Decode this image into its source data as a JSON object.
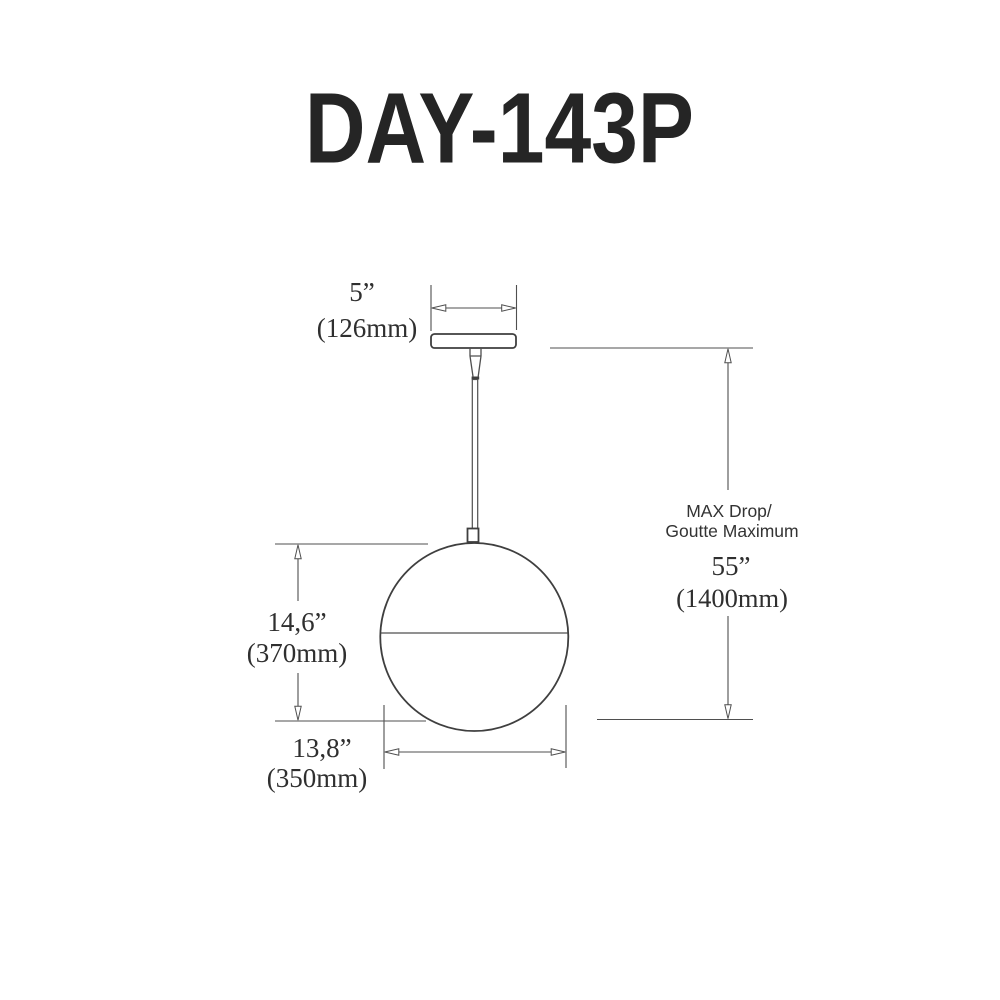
{
  "title": "DAY-143P",
  "colors": {
    "background": "#ffffff",
    "outline": "#3f3f3f",
    "dimension_line": "#4f4f4f",
    "text": "#2f2f2f"
  },
  "dimensions": {
    "canopy_width": {
      "inches": "5”",
      "mm": "(126mm)"
    },
    "globe_height": {
      "inches": "14,6”",
      "mm": "(370mm)"
    },
    "globe_width": {
      "inches": "13,8”",
      "mm": "(350mm)"
    },
    "max_drop": {
      "label_en": "MAX Drop/",
      "label_fr": "Goutte Maximum",
      "inches": "55”",
      "mm": "(1400mm)"
    }
  }
}
